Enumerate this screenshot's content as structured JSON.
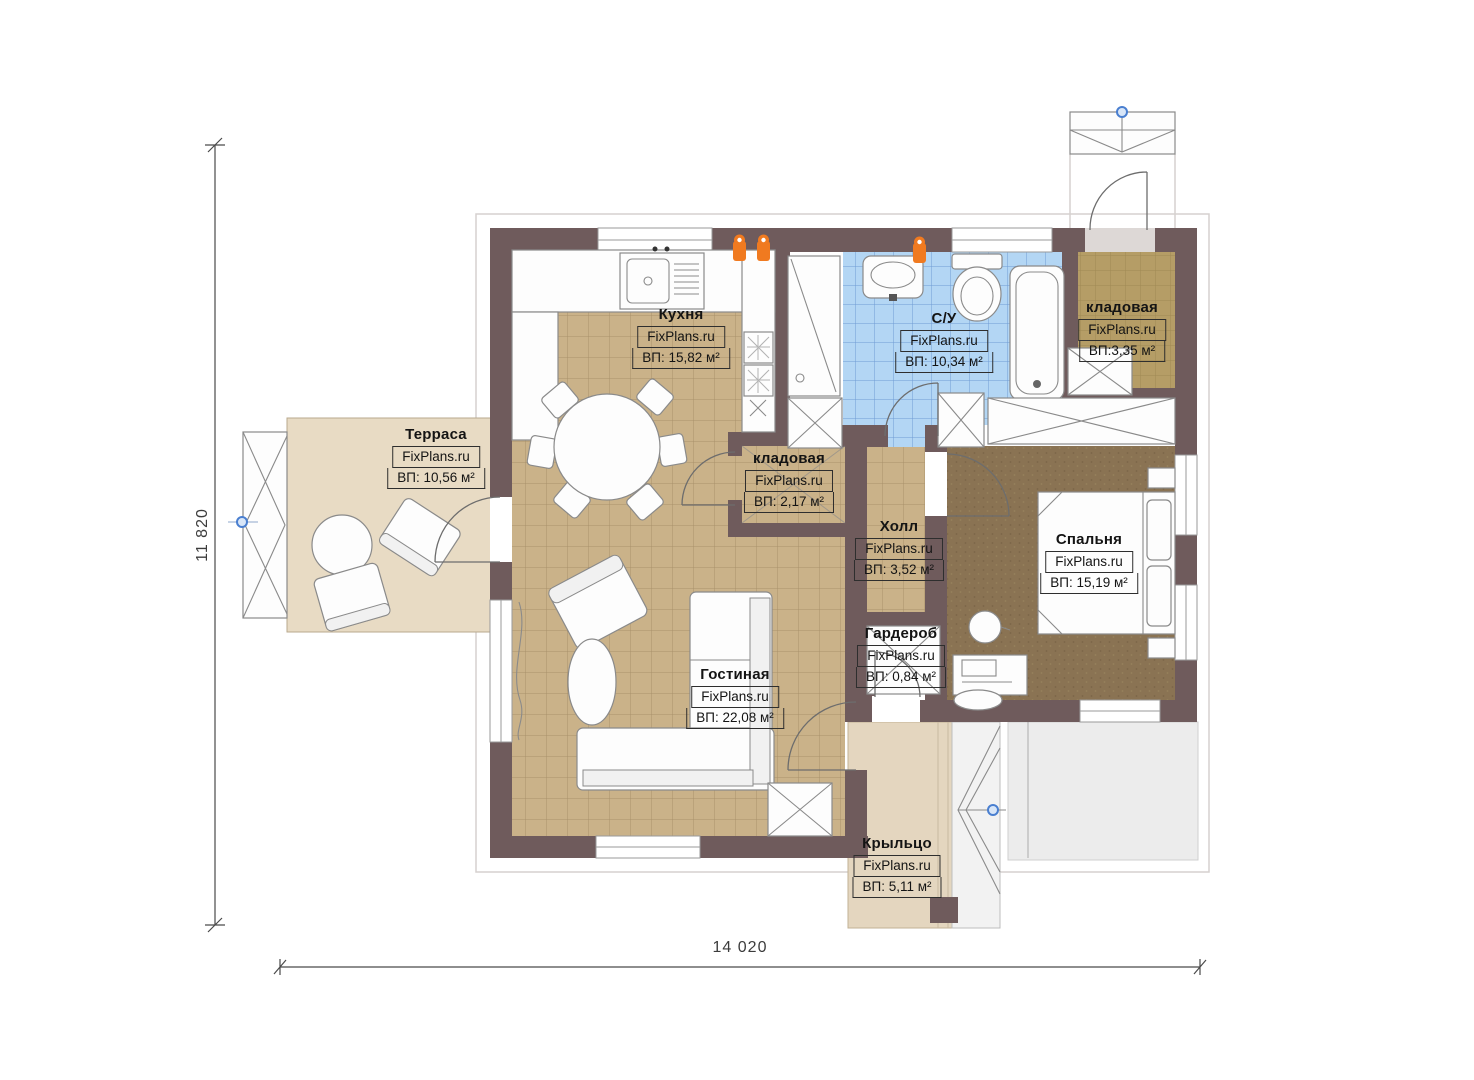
{
  "brand": "FixPlans.ru",
  "dimensions": {
    "width": "14 020",
    "height": "11 820"
  },
  "rooms": {
    "kitchen": {
      "name": "Кухня",
      "area": "ВП: 15,82 м²"
    },
    "terrace": {
      "name": "Терраса",
      "area": "ВП: 10,56 м²"
    },
    "living": {
      "name": "Гостиная",
      "area": "ВП: 22,08 м²"
    },
    "storage_small": {
      "name": "кладовая",
      "area": "ВП: 2,17 м²"
    },
    "bathroom": {
      "name": "С/У",
      "area": "ВП: 10,34 м²"
    },
    "storage_top": {
      "name": "кладовая",
      "area": "ВП:3,35 м²"
    },
    "hall": {
      "name": "Холл",
      "area": "ВП: 3,52 м²"
    },
    "bedroom": {
      "name": "Спальня",
      "area": "ВП: 15,19 м²"
    },
    "wardrobe": {
      "name": "Гардероб",
      "area": "ВП: 0,84 м²"
    },
    "porch": {
      "name": "Крыльцо",
      "area": "ВП: 5,11 м²"
    }
  },
  "colors": {
    "wall": "#6f5b5c",
    "floor_tile": "#cab289",
    "floor_terrace": "#e8dbc4",
    "floor_porch": "#e4d6bf",
    "floor_bath": "#b3d6f4",
    "floor_storage": "#b59d66",
    "floor_bedroom": "#8a7353",
    "accent_orange": "#f07a20",
    "accent_blue": "#4a7fd0",
    "dim": "#4a4a4a"
  }
}
